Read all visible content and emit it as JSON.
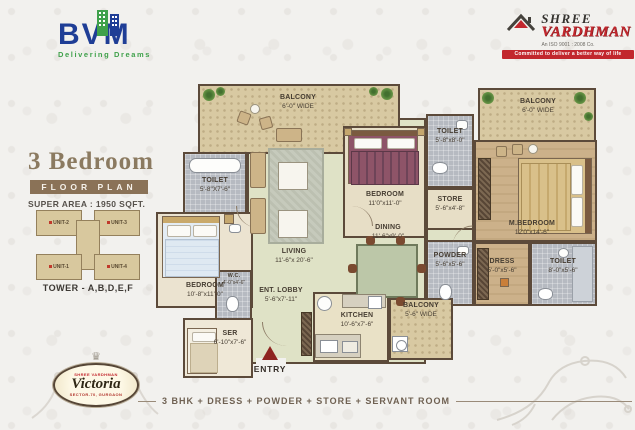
{
  "branding": {
    "bvm": {
      "name": "BVM",
      "tagline": "Delivering Dreams"
    },
    "shree": {
      "line1": "SHREE",
      "line2": "VARDHMAN",
      "iso": "An ISO 9001 : 2008 Co.",
      "ribbon": "Committed to deliver a better way of life"
    }
  },
  "plan_info": {
    "title": "3 Bedroom",
    "banner": "FLOOR PLAN",
    "super_area": "SUPER AREA : 1950 SQFT."
  },
  "tower": {
    "label": "TOWER - A,B,D,E,F",
    "units": [
      "UNIT-1",
      "UNIT-2",
      "UNIT-3",
      "UNIT-4"
    ]
  },
  "victoria": {
    "brand": "SHREE VARDHMAN",
    "name": "Victoria",
    "location": "SECTOR-70, GURGAON"
  },
  "footer": {
    "text": "3 BHK + DRESS + POWDER + STORE + SERVANT ROOM"
  },
  "entry": {
    "label": "ENTRY"
  },
  "rooms": {
    "balcony_tl": {
      "name": "BALCONY",
      "dim": "6'-0\" WIDE"
    },
    "balcony_tr": {
      "name": "BALCONY",
      "dim": "6'-0\" WIDE"
    },
    "toilet1": {
      "name": "TOILET",
      "dim": "5'-8\"X7'-6\""
    },
    "toilet2": {
      "name": "TOILET",
      "dim": "5'-8\"x8'-0\""
    },
    "bedroom2": {
      "name": "BEDROOM",
      "dim": "11'0\"x11'-0\""
    },
    "store": {
      "name": "STORE",
      "dim": "5'-6\"x4'-8\""
    },
    "mbedroom": {
      "name": "M.BEDROOM",
      "dim": "12'0\"x14'-6\""
    },
    "dining": {
      "name": "DINING",
      "dim": "11'-6\"x9'-0\""
    },
    "powder": {
      "name": "POWDER",
      "dim": "5'-6\"x5'-6\""
    },
    "dress": {
      "name": "DRESS",
      "dim": "5'-0\"x5'-6\""
    },
    "toilet3": {
      "name": "TOILET",
      "dim": "8'-0\"x5'-6\""
    },
    "living": {
      "name": "LIVING",
      "dim": "11'-6\"x 20'-6\""
    },
    "bedroom1": {
      "name": "BEDROOM",
      "dim": "10'-8\"x11'-0\""
    },
    "wc": {
      "name": "W.C.",
      "dim": "4'-0\"x4'-6\""
    },
    "ser": {
      "name": "SER",
      "dim": "6'-10\"x7'-6\""
    },
    "lobby": {
      "name": "ENT. LOBBY",
      "dim": "5'-6\"x7'-11\""
    },
    "kitchen": {
      "name": "KITCHEN",
      "dim": "10'-6\"x7'-6\""
    },
    "balcony_b": {
      "name": "BALCONY",
      "dim": "5'-6\" WIDE"
    }
  }
}
